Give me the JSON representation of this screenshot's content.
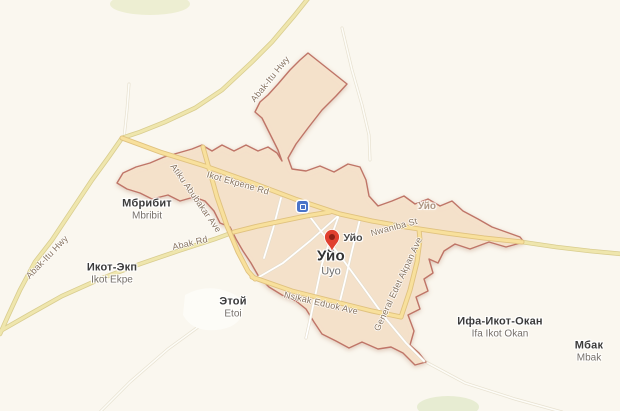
{
  "map": {
    "city_marker": {
      "name_ru": "Уйо",
      "name_en": "Uyo"
    },
    "settlements": [
      {
        "name_ru": "Мбрибит",
        "name_en": "Mbribit"
      },
      {
        "name_ru": "Икот-Экп",
        "name_en": "Ikot Ekpe"
      },
      {
        "name_ru": "Этой",
        "name_en": "Etoi"
      },
      {
        "name_ru": "Ифа-Икот-Окан",
        "name_en": "Ifa Ikot Okan"
      },
      {
        "name_ru": "Мбак",
        "name_en": "Mbak"
      }
    ],
    "district_labels": [
      {
        "text": "Уйо"
      },
      {
        "text": "Уйо"
      }
    ],
    "road_labels": [
      {
        "name": "Abak-Itu Hwy"
      },
      {
        "name": "Abak-Itu Hwy"
      },
      {
        "name": "Ikot Ekpene Rd"
      },
      {
        "name": "Atiku Abubakar Ave"
      },
      {
        "name": "Abak Rd"
      },
      {
        "name": "Nwaniba St"
      },
      {
        "name": "Nsikak Eduok Ave"
      },
      {
        "name": "General Edet Akpan Ave"
      }
    ],
    "icons": {
      "marker": "red-map-pin",
      "station": "transit-station-icon"
    },
    "colors": {
      "background": "#faf7ef",
      "city_area_fill": "#f5e2ca",
      "city_area_border": "#bf7467",
      "major_road_fill": "#f8e09c",
      "rural_road_fill": "#efe6ad",
      "marker_red": "#e0402f",
      "station_blue": "#4a74c9",
      "settlement_label": "#3b3b3b",
      "latin_label": "#76706a",
      "road_label": "#887460"
    }
  }
}
